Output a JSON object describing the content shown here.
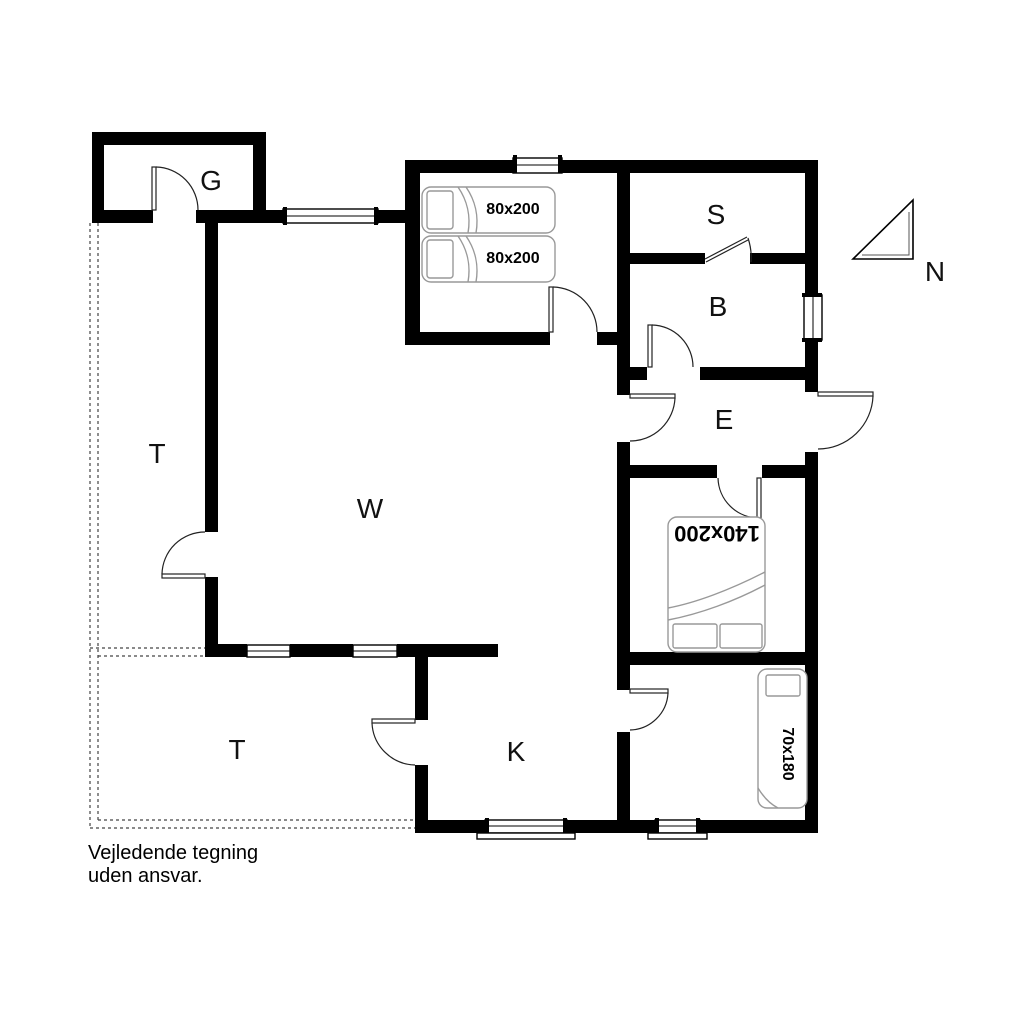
{
  "floor_plan": {
    "title": "Holiday house floor plan",
    "room_labels": [
      {
        "id": "room-g",
        "text": "G"
      },
      {
        "id": "room-s",
        "text": "S"
      },
      {
        "id": "room-b",
        "text": "B"
      },
      {
        "id": "room-e",
        "text": "E"
      },
      {
        "id": "room-w",
        "text": "W"
      },
      {
        "id": "room-t-upper",
        "text": "T"
      },
      {
        "id": "room-t-lower",
        "text": "T"
      },
      {
        "id": "room-k",
        "text": "K"
      }
    ],
    "bed_labels": [
      {
        "id": "bed-single-1",
        "text": "80x200"
      },
      {
        "id": "bed-single-2",
        "text": "80x200"
      },
      {
        "id": "bed-double",
        "text": "140x200"
      },
      {
        "id": "bed-small",
        "text": "70x180"
      }
    ],
    "compass": {
      "label": "N"
    },
    "disclaimer": [
      "Vejledende tegning",
      "uden ansvar."
    ],
    "colors": {
      "wall": "#000000",
      "background": "#ffffff",
      "furniture_outline": "#999999",
      "door_line": "#222222",
      "terrace_dash": "#444444"
    }
  }
}
